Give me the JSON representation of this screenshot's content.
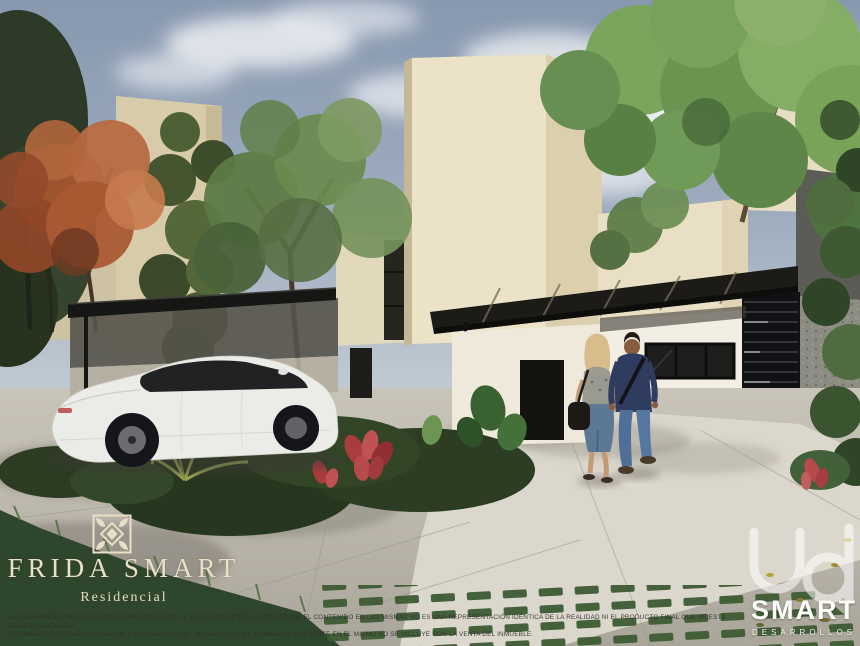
{
  "image": {
    "type": "architectural-render",
    "subject": "Modern beige residential houses with black carport canopies, tropical landscaping, a white sedan parked under the left carport and a couple walking toward the entrance on the right"
  },
  "branding": {
    "frida": {
      "name": "FRIDA SMART",
      "tagline": "Residencial",
      "emblem": "talavera-tile-icon",
      "text_color": "#e9dfc7"
    },
    "developer": {
      "name": "SMART",
      "subtitle": "DESARROLLOS",
      "monogram": "ud-monogram-icon",
      "text_color": "#ffffff"
    }
  },
  "disclaimer": {
    "line1": "LAS SIGUIENTES IMÁGENES SON PARA FINES ÚNICA Y EXCLUSIVAMENTE ILUSTRATIVOS, EL CONTENIDO EN LAS MISMAS NO ES UNA REPRESENTACIÓN IDÉNTICA DE LA REALIDAD NI EL PRODUCTO FINAL QUE SE ESTÁ COMERCIALIZANDO.",
    "line2": "SU FINALIDAD ES DAR UNA IDEA DE LOS ESPACIOS DEL DESARROLLO, EL MOBILIARIO PRESENTE EN EL MISMO NO SE INCLUYE CON LA VENTA DEL INMUEBLE."
  },
  "palette": {
    "sky": "#8fa0b6",
    "cream_wall": "#ebe2c8",
    "black_structure": "#161615",
    "foliage_green": "#5d7d47",
    "orange_tree": "#a3552f",
    "concrete": "#c6c1b6",
    "denim": "#5d7894",
    "accent_flower_red": "#b04040",
    "logo_cream": "#e9dfc7"
  }
}
